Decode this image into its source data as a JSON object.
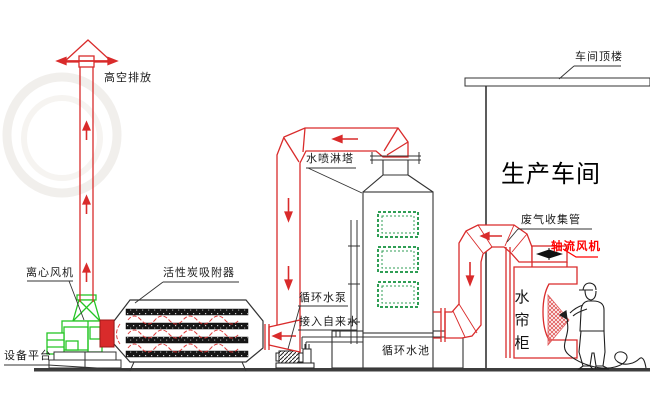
{
  "labels": {
    "high_discharge": "高空排放",
    "roof": "车间顶楼",
    "spray_tower": "水喷淋塔",
    "workshop": "生产车间",
    "gas_collect_pipe": "废气收集管",
    "axial_fan": "轴流风机",
    "centrifugal_fan": "离心风机",
    "carbon_adsorber": "活性炭吸附器",
    "circulating_pump": "循环水泵",
    "tap_water": "接入自来水",
    "circulating_pool": "循环水池",
    "water_curtain_cabinet": "水帘柜",
    "equipment_platform": "设备平台"
  },
  "icons": {
    "rain_cap": "chimney-rain-cap",
    "axial_fan_propeller": "propeller-blade",
    "spray_cone": "paint-spray-mist",
    "painter": "worker-with-spray-gun"
  },
  "colors": {
    "duct_red": "#d92b2b",
    "fan_green": "#25c525",
    "window_green": "#2f9e55",
    "line_dark": "#333333",
    "highlight_red": "#ff0000",
    "ground": "#3d3d3d"
  }
}
